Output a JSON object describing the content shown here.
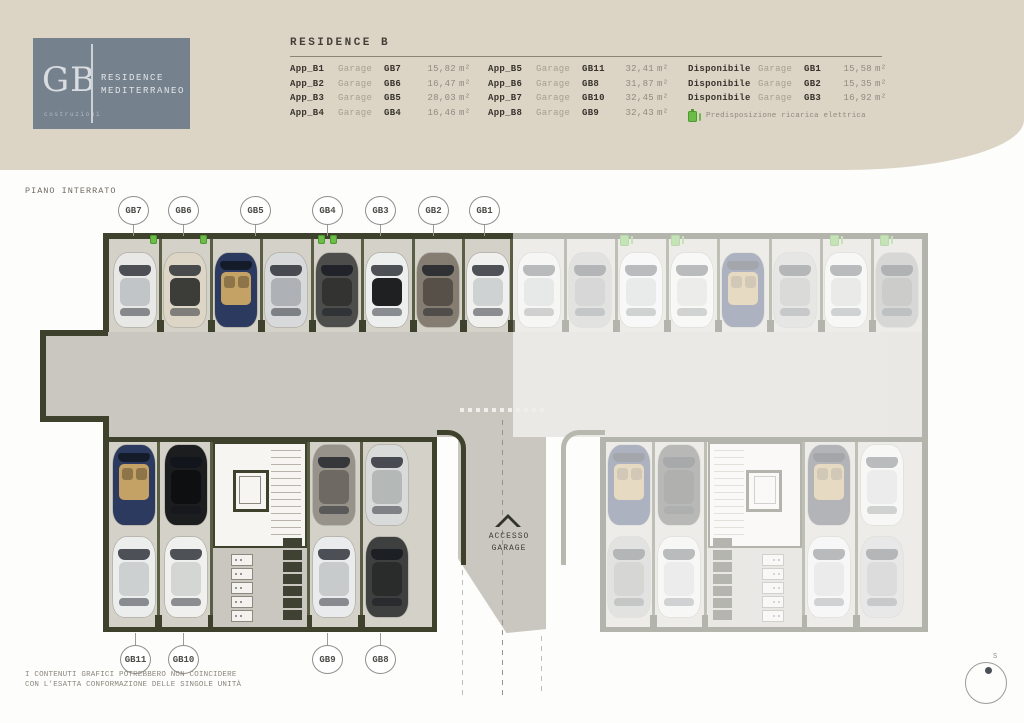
{
  "header": {
    "logo": {
      "initials": "GB",
      "tagline": "costruzioni",
      "name_line1": "RESIDENCE",
      "name_line2": "MEDITERRANEO"
    },
    "table": {
      "title": "RESIDENCE B",
      "columns": [
        {
          "rows": [
            {
              "label": "App_B1",
              "mid": "Garage",
              "garage": "GB7",
              "value": "15,82",
              "unit": "m²"
            },
            {
              "label": "App_B2",
              "mid": "Garage",
              "garage": "GB6",
              "value": "16,47",
              "unit": "m²"
            },
            {
              "label": "App_B3",
              "mid": "Garage",
              "garage": "GB5",
              "value": "28,03",
              "unit": "m²"
            },
            {
              "label": "App_B4",
              "mid": "Garage",
              "garage": "GB4",
              "value": "16,46",
              "unit": "m²"
            }
          ]
        },
        {
          "rows": [
            {
              "label": "App_B5",
              "mid": "Garage",
              "garage": "GB11",
              "value": "32,41",
              "unit": "m²"
            },
            {
              "label": "App_B6",
              "mid": "Garage",
              "garage": "GB8",
              "value": "31,87",
              "unit": "m²"
            },
            {
              "label": "App_B7",
              "mid": "Garage",
              "garage": "GB10",
              "value": "32,45",
              "unit": "m²"
            },
            {
              "label": "App_B8",
              "mid": "Garage",
              "garage": "GB9",
              "value": "32,43",
              "unit": "m²"
            }
          ]
        },
        {
          "rows": [
            {
              "label": "Disponibile",
              "mid": "Garage",
              "garage": "GB1",
              "value": "15,58",
              "unit": "m²"
            },
            {
              "label": "Disponibile",
              "mid": "Garage",
              "garage": "GB2",
              "value": "15,35",
              "unit": "m²"
            },
            {
              "label": "Disponibile",
              "mid": "Garage",
              "garage": "GB3",
              "value": "16,92",
              "unit": "m²"
            }
          ],
          "legend": "Predisposizione ricarica elettrica"
        }
      ]
    }
  },
  "plan": {
    "floor_label": "PIANO INTERRATO",
    "top_labels": [
      "GB7",
      "GB6",
      "GB5",
      "GB4",
      "GB3",
      "GB2",
      "GB1"
    ],
    "bottom_labels": [
      "GB11",
      "GB10",
      "GB9",
      "GB8"
    ],
    "ramp_line1": "ACCESSO",
    "ramp_line2": "GARAGE",
    "compass_label": "S"
  },
  "footer": {
    "disclaimer_line1": "I CONTENUTI GRAFICI POTREBBERO NON COINCIDERE",
    "disclaimer_line2": "CON L'ESATTA CONFORMAZIONE DELLE SINGOLE UNITÀ"
  },
  "colors": {
    "header_beige": "#dcd4c5",
    "brand_blue_gray": "#75818d",
    "wall_olive": "#3e422d",
    "divider_olive": "#5a5e44",
    "floor_gray": "#d4d1c9",
    "corridor_gray": "#cac7c0",
    "ev_green": "#6cbd47"
  }
}
